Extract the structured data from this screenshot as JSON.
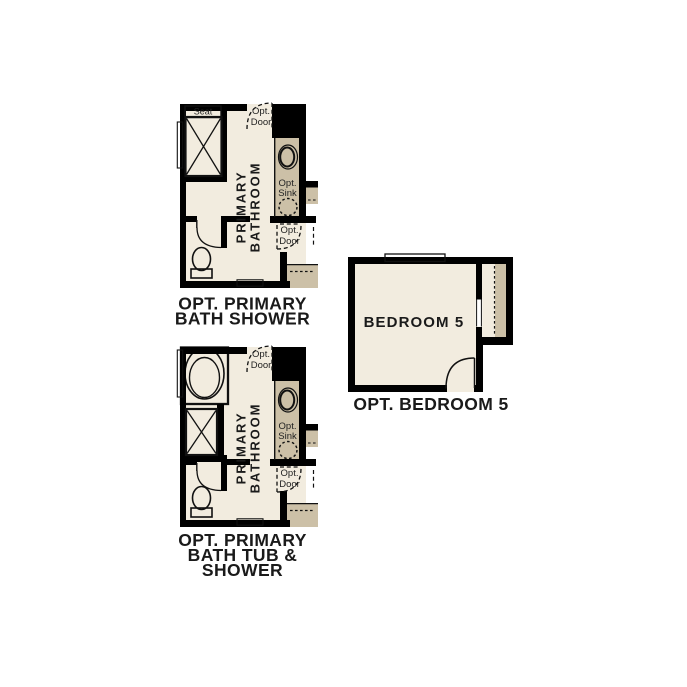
{
  "colors": {
    "wall": "#000000",
    "floor": "#f2ecdf",
    "counter_tan": "#ccc0a7",
    "fixture_blue": "#b5cde9",
    "text": "#1a1a1a",
    "background": "#ffffff"
  },
  "plans": {
    "bath_shower": {
      "caption_line1": "OPT. PRIMARY",
      "caption_line2": "BATH SHOWER",
      "room_line1": "PRIMARY",
      "room_line2": "BATHROOM",
      "seat": "Seat",
      "opt_door_top_line1": "Opt.",
      "opt_door_top_line2": "Door",
      "opt_sink_line1": "Opt.",
      "opt_sink_line2": "Sink",
      "opt_door_side_line1": "Opt.",
      "opt_door_side_line2": "Door"
    },
    "bath_tub_shower": {
      "caption_line1": "OPT. PRIMARY",
      "caption_line2": "BATH TUB &",
      "caption_line3": "SHOWER",
      "room_line1": "PRIMARY",
      "room_line2": "BATHROOM",
      "opt_door_top_line1": "Opt.",
      "opt_door_top_line2": "Door",
      "opt_sink_line1": "Opt.",
      "opt_sink_line2": "Sink",
      "opt_door_side_line1": "Opt.",
      "opt_door_side_line2": "Door"
    },
    "bedroom5": {
      "room_label": "BEDROOM 5",
      "caption": "OPT. BEDROOM 5"
    }
  }
}
